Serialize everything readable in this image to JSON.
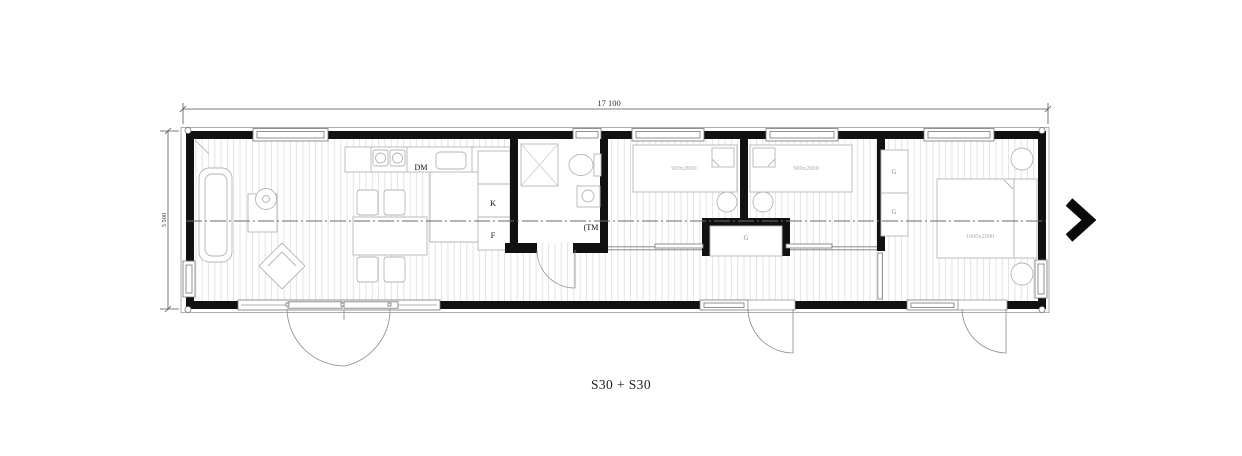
{
  "dimensions": {
    "length": "17 100",
    "width": "3 500"
  },
  "caption": "S30 + S30",
  "labels": {
    "dishwasher": "DM",
    "fridge": "K",
    "freezer": "F",
    "washing_machine": "(TM",
    "wardrobe_hall": "G",
    "wardrobe_master_top": "G",
    "wardrobe_master_bottom": "G",
    "bed_single_left": "900x2000",
    "bed_single_right": "900x2000",
    "bed_double": "1600x2000"
  },
  "nav": {
    "next_icon": "chevron-right"
  },
  "colors": {
    "wall": "#111111",
    "furniture_line": "#b5b5b5",
    "hatch": "#dcdcdc",
    "dim_text": "#333333",
    "muted_text": "#9a9a9a"
  }
}
